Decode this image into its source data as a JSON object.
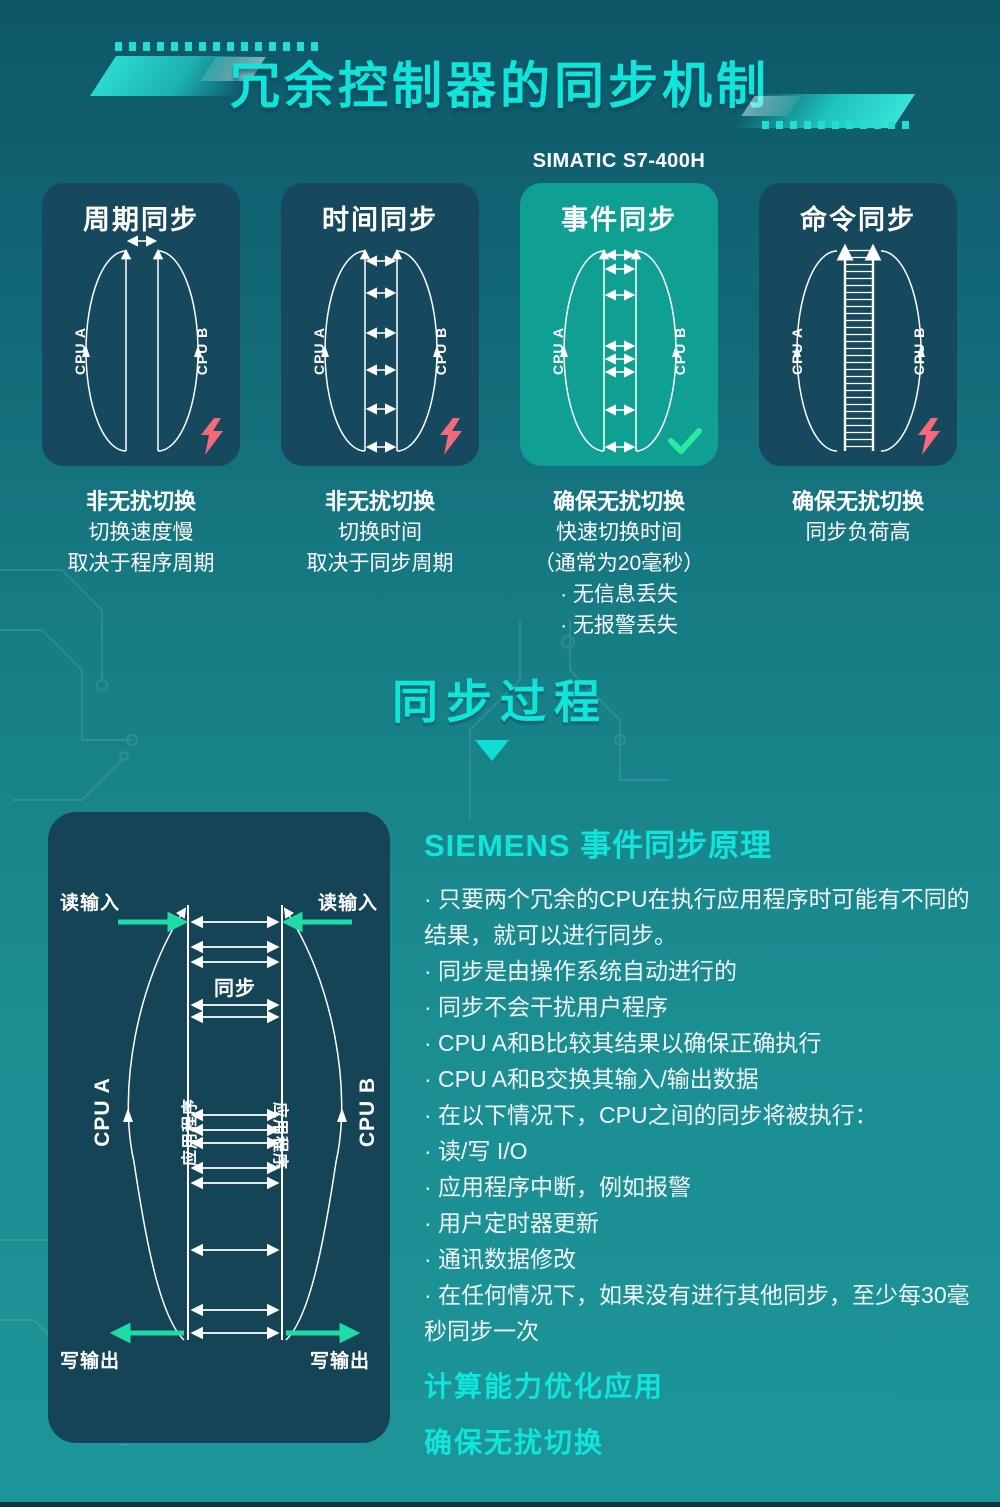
{
  "header": {
    "title": "冗余控制器的同步机制",
    "subtitle": "SIMATIC S7-400H",
    "section_title": "同步过程"
  },
  "cards": [
    {
      "title": "周期同步",
      "cpu_a": "CPU A",
      "cpu_b": "CPU B",
      "status_icon": "lightning-icon",
      "desc_title": "非无扰切换",
      "desc_lines": [
        "切换速度慢",
        "取决于程序周期"
      ]
    },
    {
      "title": "时间同步",
      "cpu_a": "CPU A",
      "cpu_b": "CPU B",
      "status_icon": "lightning-icon",
      "desc_title": "非无扰切换",
      "desc_lines": [
        "切换时间",
        "取决于同步周期"
      ]
    },
    {
      "title": "事件同步",
      "cpu_a": "CPU A",
      "cpu_b": "CPU B",
      "status_icon": "check-icon",
      "desc_title": "确保无扰切换",
      "desc_lines": [
        "快速切换时间",
        "（通常为20毫秒）",
        "· 无信息丢失",
        "· 无报警丢失"
      ]
    },
    {
      "title": "命令同步",
      "cpu_a": "CPU A",
      "cpu_b": "CPU B",
      "status_icon": "lightning-icon",
      "desc_title": "确保无扰切换",
      "desc_lines": [
        "同步负荷高"
      ]
    }
  ],
  "process": {
    "read_in_left": "读输入",
    "read_in_right": "读输入",
    "sync": "同步",
    "app_left": "应用程序",
    "app_right": "应用程序",
    "cpu_a": "CPU A",
    "cpu_b": "CPU B",
    "write_out_left": "写输出",
    "write_out_right": "写输出"
  },
  "principle": {
    "title": "SIEMENS 事件同步原理",
    "bullets": [
      "· 只要两个冗余的CPU在执行应用程序时可能有不同的结果，就可以进行同步。",
      "· 同步是由操作系统自动进行的",
      "· 同步不会干扰用户程序",
      "· CPU A和B比较其结果以确保正确执行",
      "· CPU A和B交换其输入/输出数据",
      "· 在以下情况下，CPU之间的同步将被执行：",
      "· 读/写 I/O",
      "· 应用程序中断，例如报警",
      "· 用户定时器更新",
      "· 通讯数据修改",
      "· 在任何情况下，如果没有进行其他同步，至少每30毫秒同步一次"
    ],
    "highlights": [
      "计算能力优化应用",
      "确保无扰切换"
    ]
  },
  "colors": {
    "accent_cyan": "#10E5DB",
    "card_dark": "#17495E",
    "card_selected": "#0FA093",
    "process_card": "#154457",
    "success_green": "#2BE9A0",
    "warning_pink": "#F4697B",
    "text_white": "#FFFFFF"
  }
}
